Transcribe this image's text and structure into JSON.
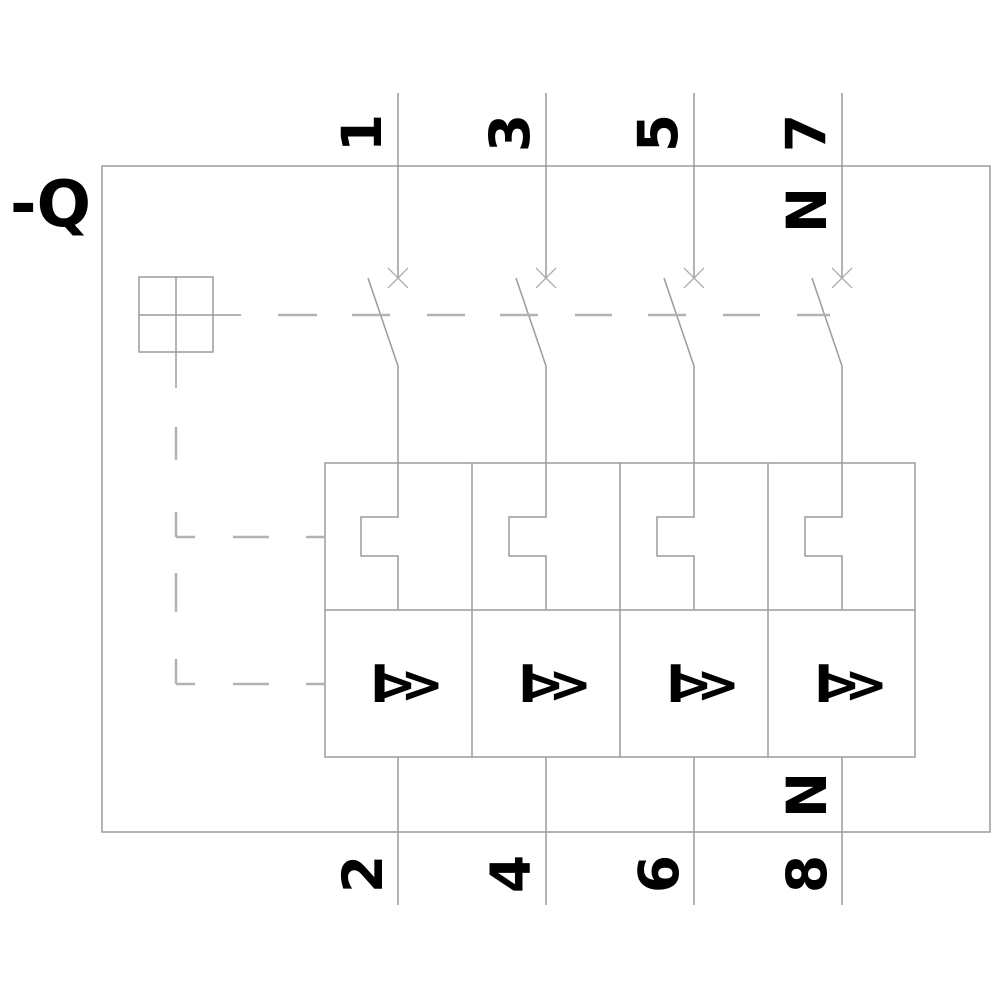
{
  "labels": {
    "reference": "-Q"
  },
  "colors": {
    "line": "#9b9b9b",
    "contact_cross": "#adadad",
    "dashed": "#b2b2b2",
    "text": "#000000",
    "background": "#ffffff"
  },
  "poles": [
    {
      "top_terminal": "1",
      "bottom_terminal": "2",
      "trip_symbol": "I>>"
    },
    {
      "top_terminal": "3",
      "bottom_terminal": "4",
      "trip_symbol": "I>>"
    },
    {
      "top_terminal": "5",
      "bottom_terminal": "6",
      "trip_symbol": "I>>"
    },
    {
      "top_terminal": "7",
      "bottom_terminal": "8",
      "trip_symbol": "I>>",
      "top_neutral_label": "N",
      "bottom_neutral_label": "N"
    }
  ]
}
